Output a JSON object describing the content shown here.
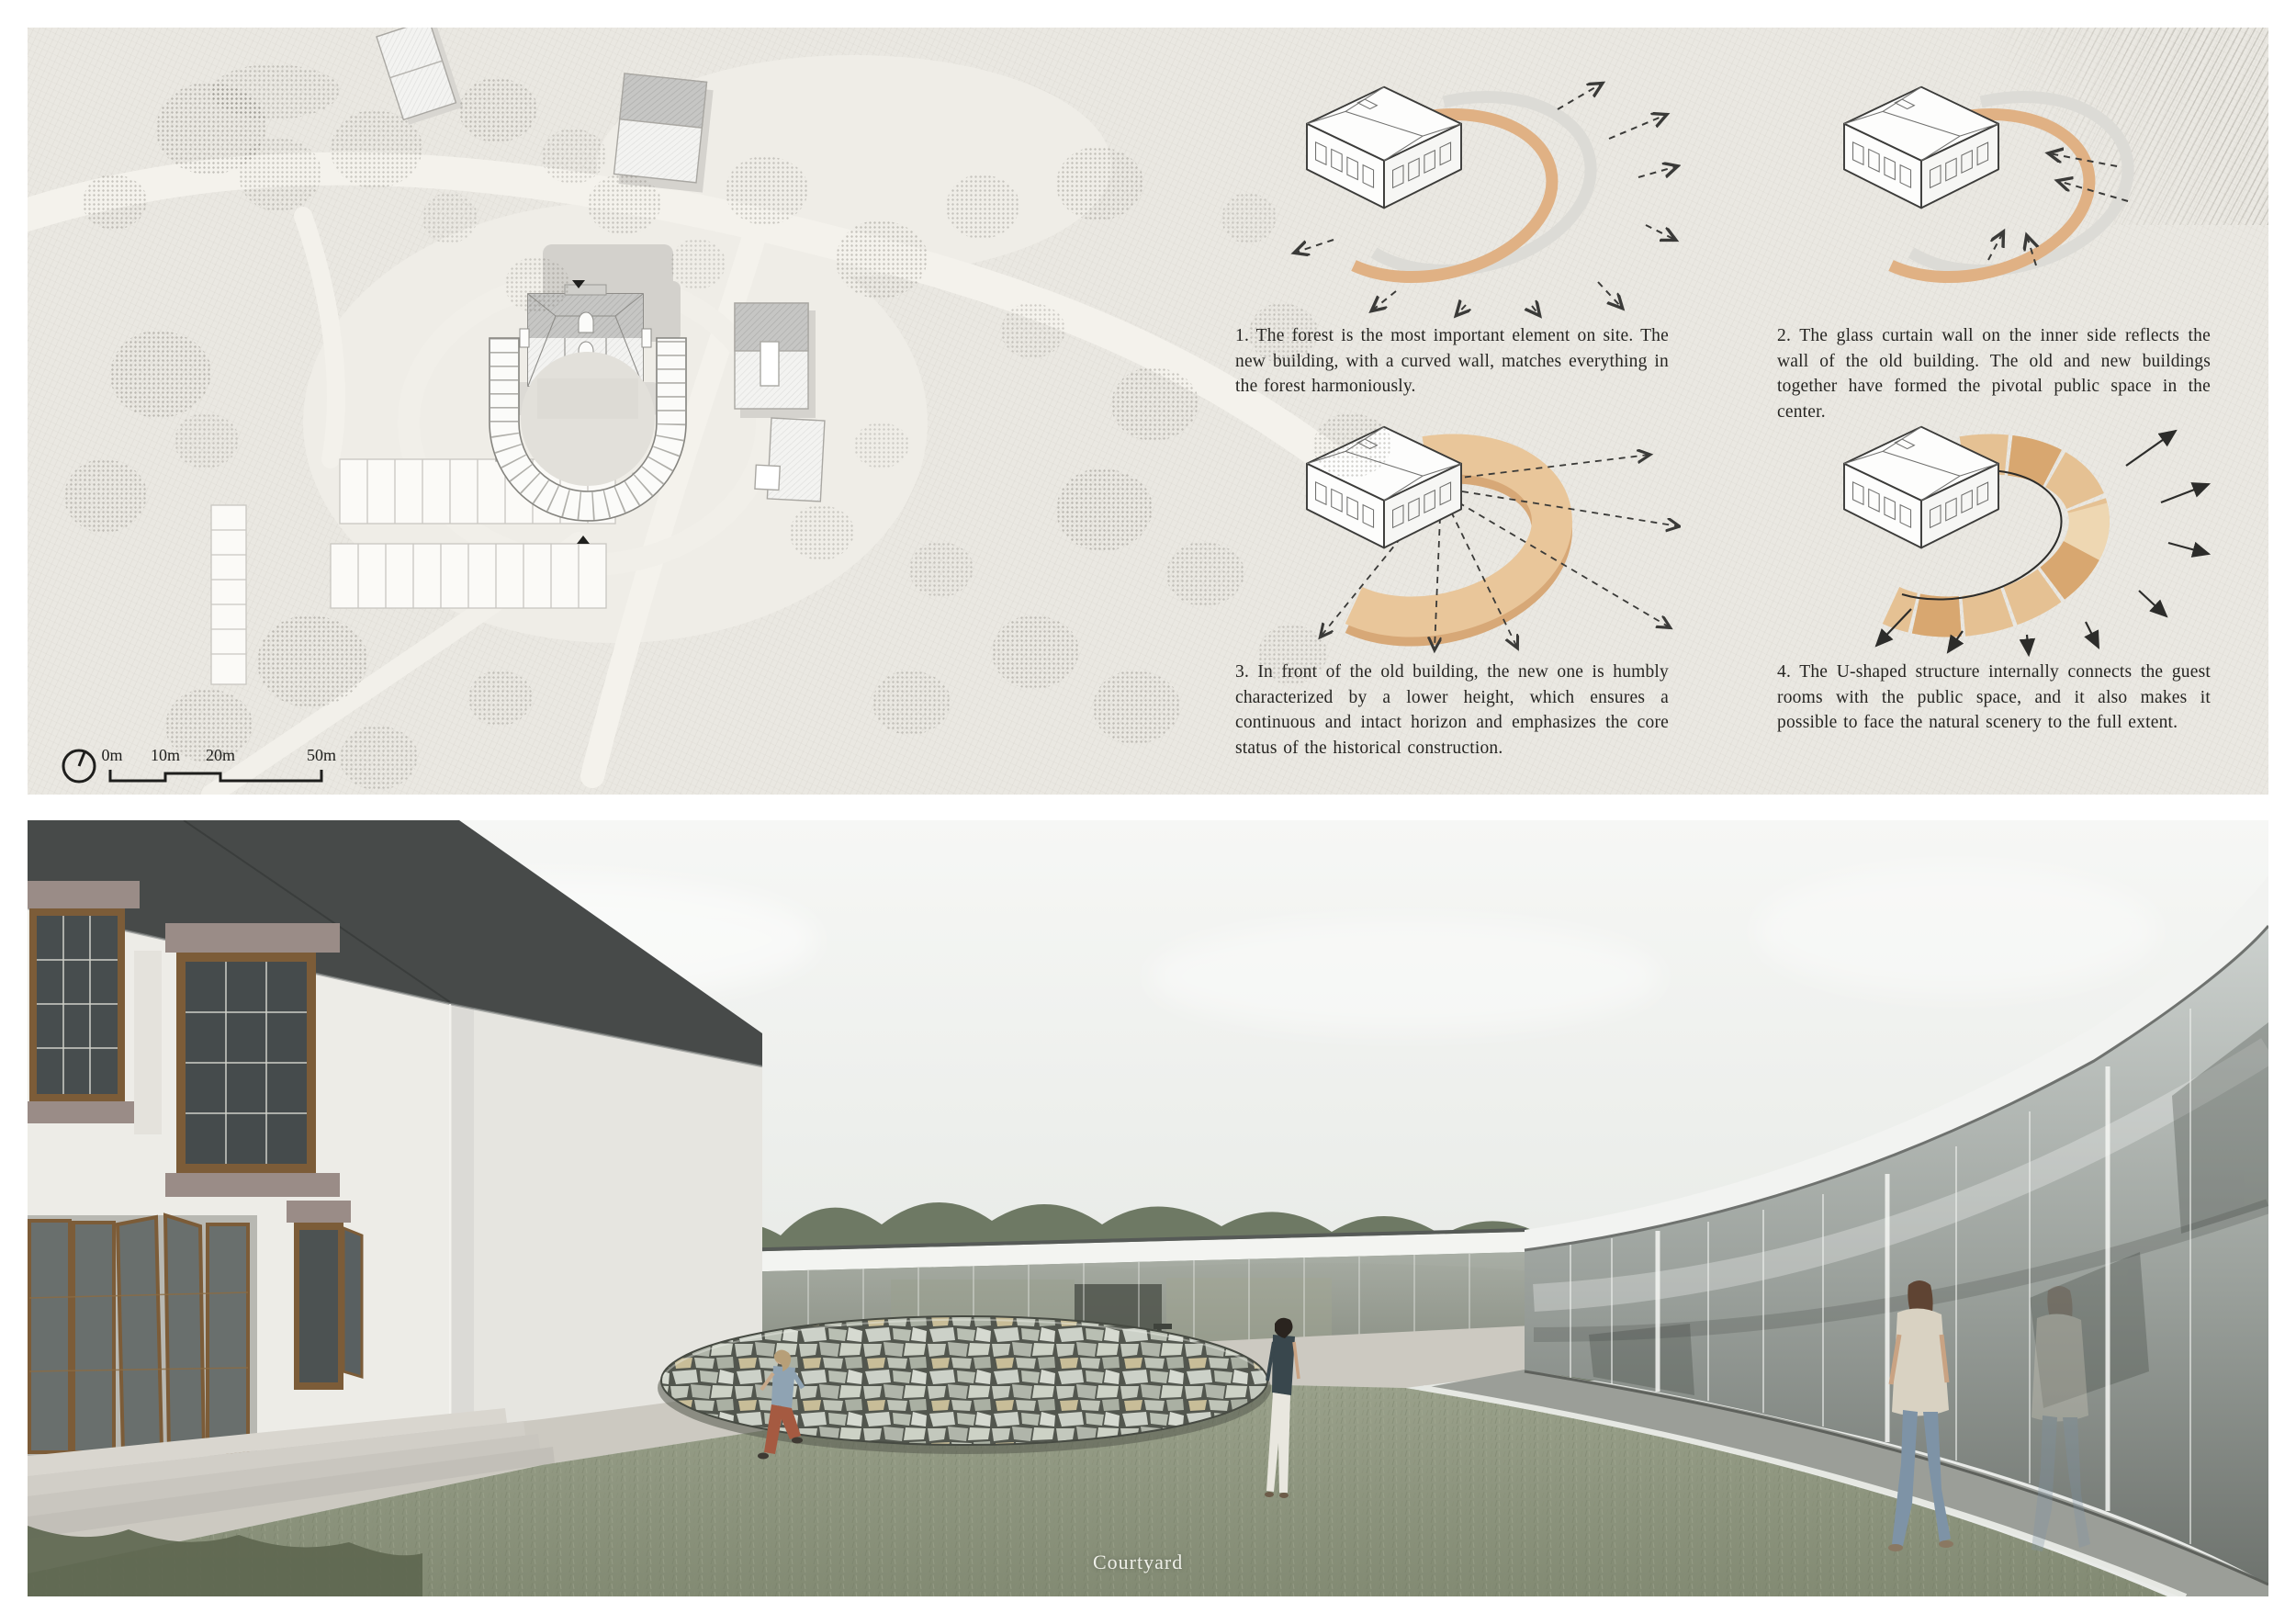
{
  "board": {
    "site_plan": {
      "scale_bar": {
        "labels": [
          "0m",
          "10m",
          "20m",
          "50m"
        ]
      }
    },
    "diagrams": [
      {
        "caption": "1. The forest is the most important element on site. The new building, with a curved wall, matches everything in the forest harmoniously."
      },
      {
        "caption": "2. The glass curtain wall on the inner side reflects the wall of the old building. The old and new buildings together have formed the pivotal public space in the center."
      },
      {
        "caption": "3. In front of the old building, the new one is humbly characterized by a lower height, which ensures a continuous and intact horizon and emphasizes the core status of the historical construction."
      },
      {
        "caption": "4. The U-shaped structure internally connects the guest rooms with the public space, and it also makes it possible to face the natural scenery to the full extent."
      }
    ],
    "render": {
      "label": "Courtyard"
    },
    "colors": {
      "paper": "#eae8e2",
      "accent_orange": "#dfb084",
      "arc_gray": "#dcdbd6",
      "ink": "#2e2d2b",
      "grass": "#99a089",
      "roof_dark": "#474a49",
      "window_frame": "#7c5c38",
      "lintel_mauve": "#9a8c87"
    }
  }
}
